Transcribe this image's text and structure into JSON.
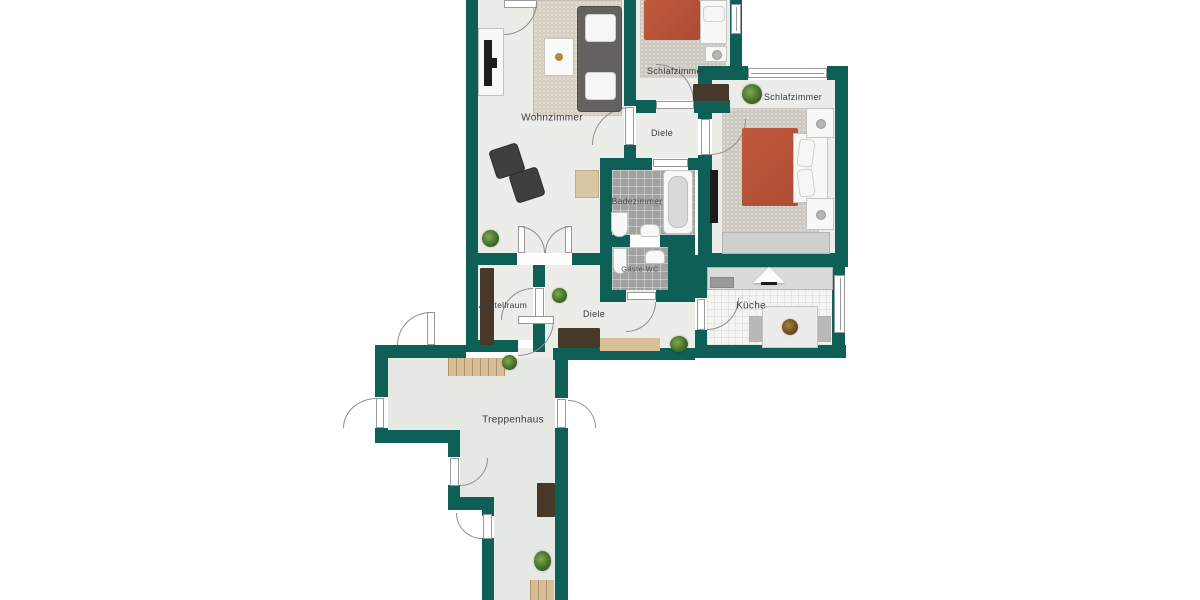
{
  "rooms": [
    {
      "id": "wohnzimmer",
      "label": "Wohnzimmer"
    },
    {
      "id": "schlafzimmer-top",
      "label": "Schlafzimmer"
    },
    {
      "id": "schlafzimmer-right",
      "label": "Schlafzimmer"
    },
    {
      "id": "diele-top",
      "label": "Diele"
    },
    {
      "id": "badezimmer",
      "label": "Badezimmer"
    },
    {
      "id": "gaeste-wc",
      "label": "Gäste-WC"
    },
    {
      "id": "kueche",
      "label": "Küche"
    },
    {
      "id": "abstellraum",
      "label": "Abstellraum"
    },
    {
      "id": "diele-middle",
      "label": "Diele"
    },
    {
      "id": "treppenhaus",
      "label": "Treppenhaus"
    }
  ],
  "colors": {
    "wall": "#0e5f56",
    "floor": "#ecede9",
    "stairwell_floor": "#e6e8e4",
    "bath_tile": "#a2a2a0",
    "kitchen_tile": "#f4f4f2",
    "carpet": "#cdc9c1",
    "bed_cover": "#b35138",
    "dark_wood": "#46392a",
    "stairs": "#d7bd95",
    "door_arc": "#8f8f8f"
  }
}
